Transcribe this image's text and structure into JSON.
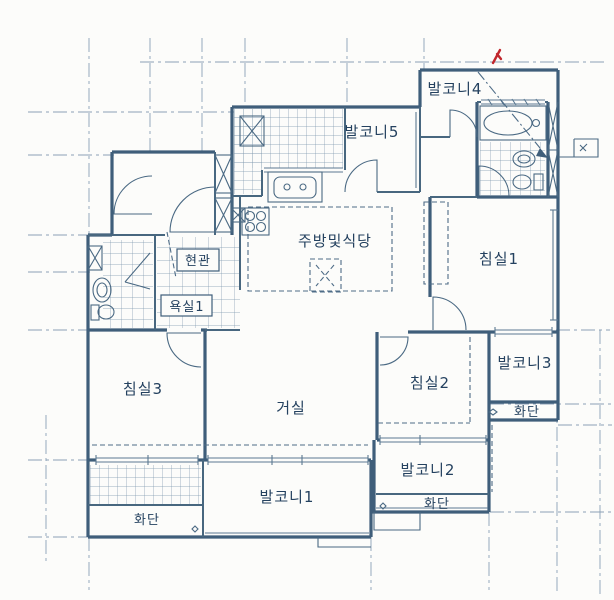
{
  "document": {
    "type": "apartment-floor-plan-scan",
    "colors": {
      "background": "#fcfcfa",
      "wall_line": "#3f5e7a",
      "thin_line": "#5b7992",
      "grid_line": "#8ba1b6",
      "label_text": "#24415f",
      "red_pen_mark": "#c1272d"
    }
  },
  "rooms": {
    "balcony4": {
      "label": "발코니4"
    },
    "balcony5": {
      "label": "발코니5"
    },
    "kitchen": {
      "label": "주방및식당"
    },
    "bedroom1": {
      "label": "침실1"
    },
    "entrance": {
      "label": "현관"
    },
    "bath1": {
      "label": "욕실1"
    },
    "bedroom3": {
      "label": "침실3"
    },
    "living": {
      "label": "거실"
    },
    "bedroom2": {
      "label": "침실2"
    },
    "balcony3": {
      "label": "발코니3"
    },
    "balcony2": {
      "label": "발코니2"
    },
    "balcony1": {
      "label": "발코니1"
    },
    "flowerbed_left": {
      "label": "화단"
    },
    "flowerbed_mid": {
      "label": "화단"
    },
    "flowerbed_right": {
      "label": "화단"
    }
  }
}
